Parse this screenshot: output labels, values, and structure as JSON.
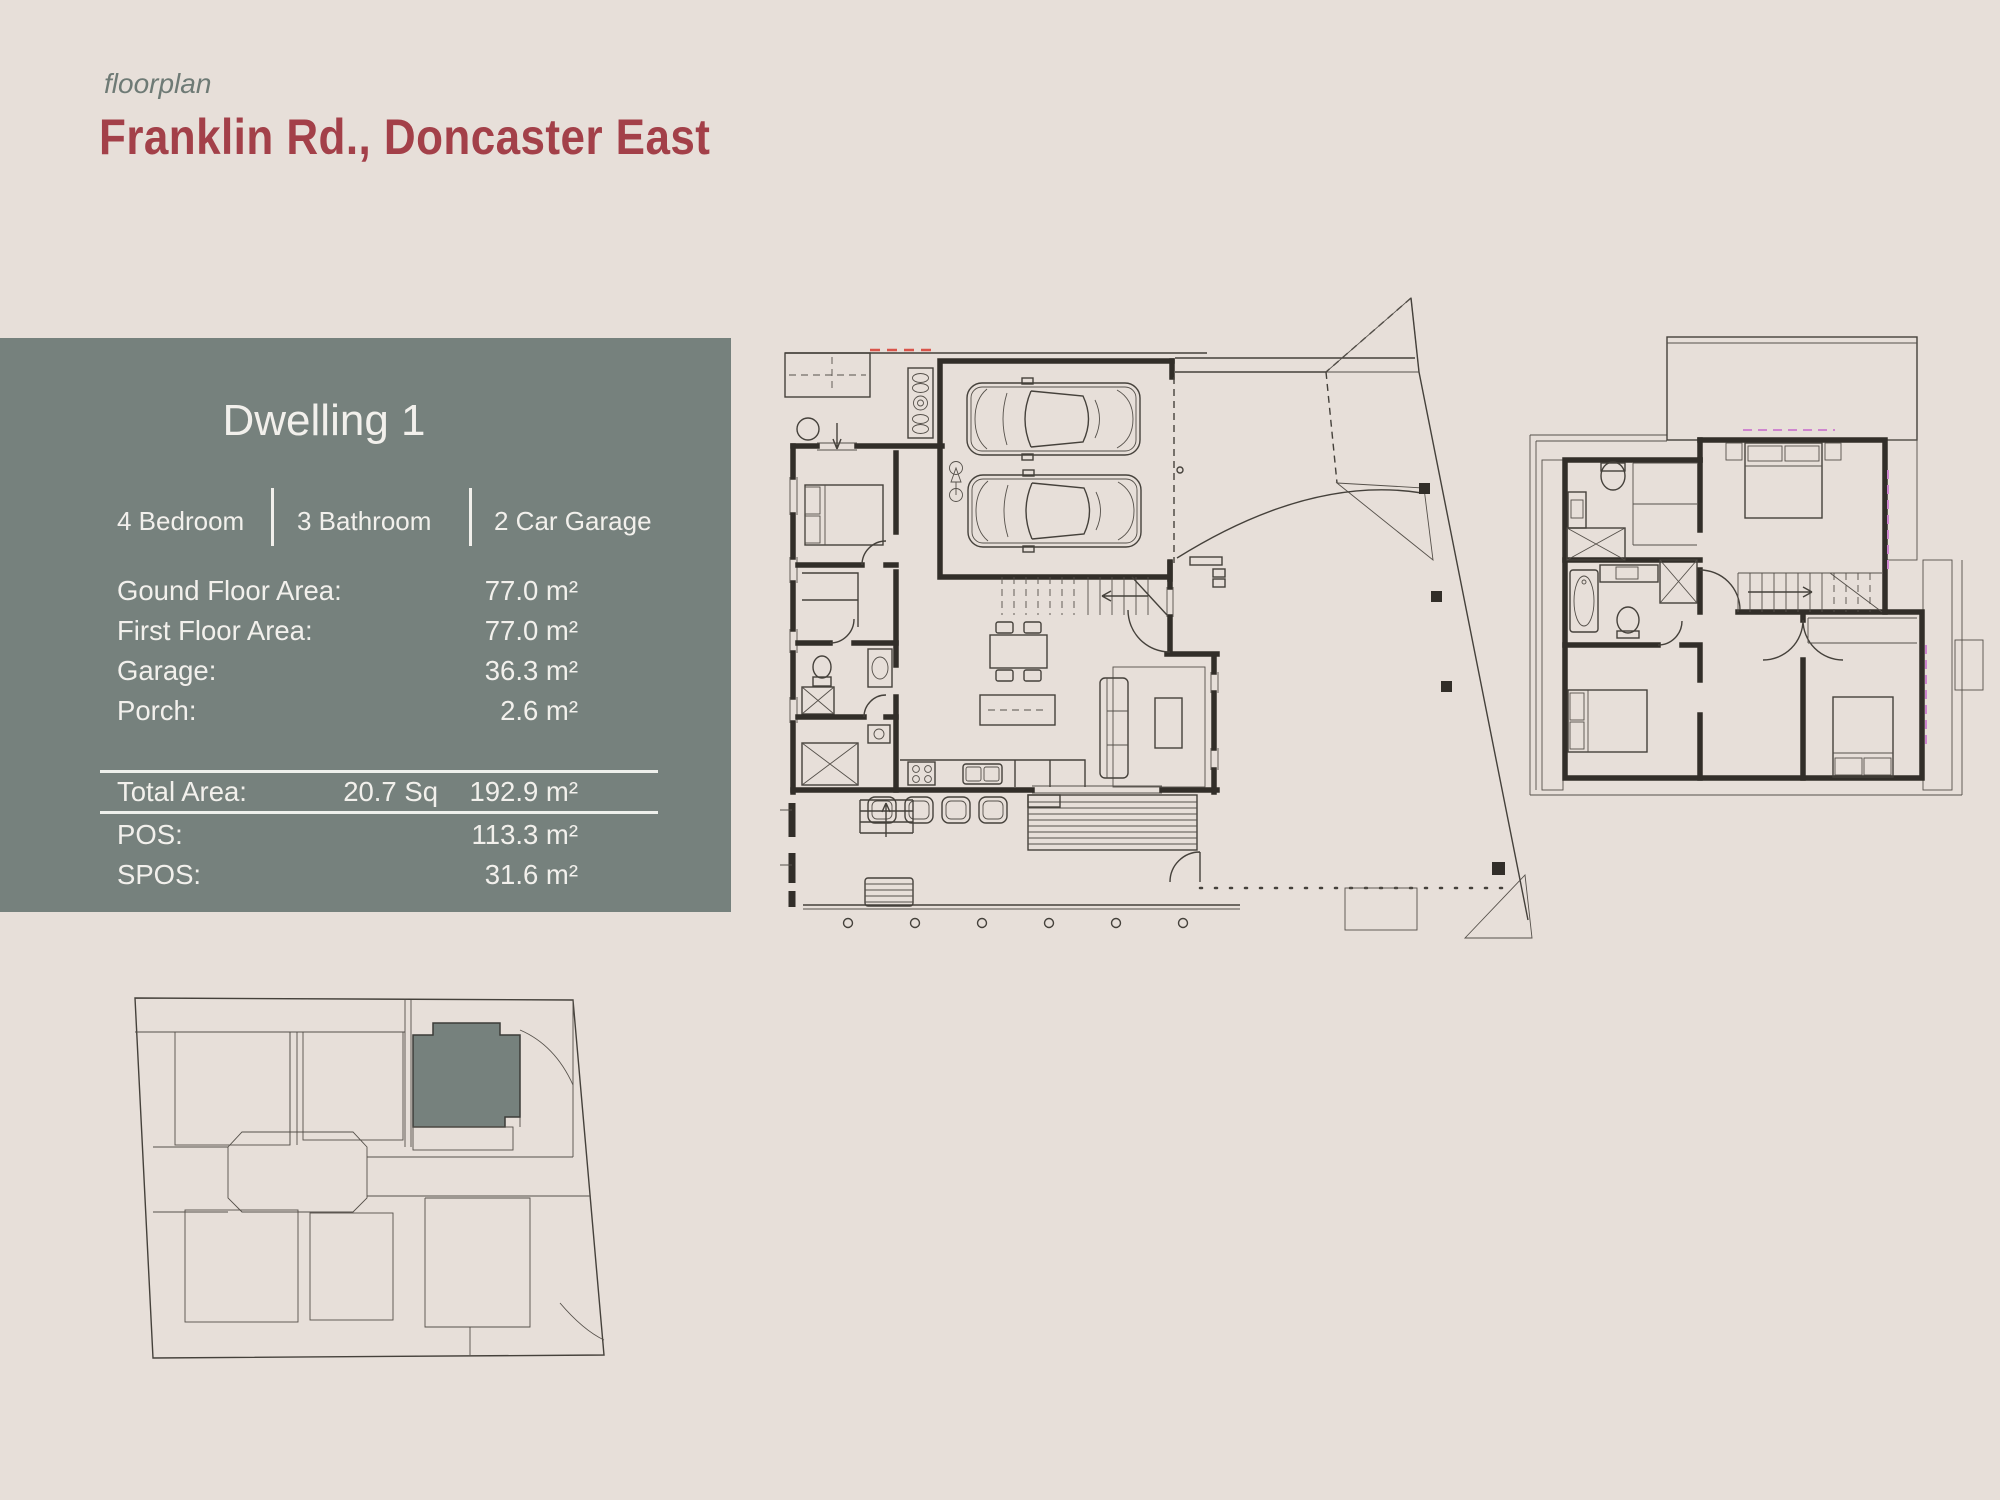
{
  "header": {
    "eyebrow": "floorplan",
    "title": "Franklin Rd., Doncaster East"
  },
  "panel": {
    "title": "Dwelling 1",
    "features": [
      {
        "label": "4 Bedroom"
      },
      {
        "label": "3 Bathroom"
      },
      {
        "label": "2 Car Garage"
      }
    ],
    "areas": [
      {
        "label": "Gound Floor Area:",
        "value": "77.0 m²"
      },
      {
        "label": "First Floor Area:",
        "value": "77.0 m²"
      },
      {
        "label": "Garage:",
        "value": "36.3 m²"
      },
      {
        "label": "Porch:",
        "value": "2.6 m²"
      }
    ],
    "total": {
      "label": "Total Area:",
      "squares": "20.7 Sq",
      "value": "192.9 m²"
    },
    "extras": [
      {
        "label": "POS:",
        "value": "113.3 m²"
      },
      {
        "label": "SPOS:",
        "value": "31.6 m²"
      }
    ]
  },
  "colors": {
    "background": "#e7dfd9",
    "panel": "#76817d",
    "panel_text": "#f2f0ec",
    "title_red": "#a34049",
    "eyebrow_gray": "#6e7a75",
    "plan_line": "#322e29",
    "site_highlight": "#76817d",
    "pink_accent": "#cf85cf",
    "red_dash": "#d9544a"
  }
}
